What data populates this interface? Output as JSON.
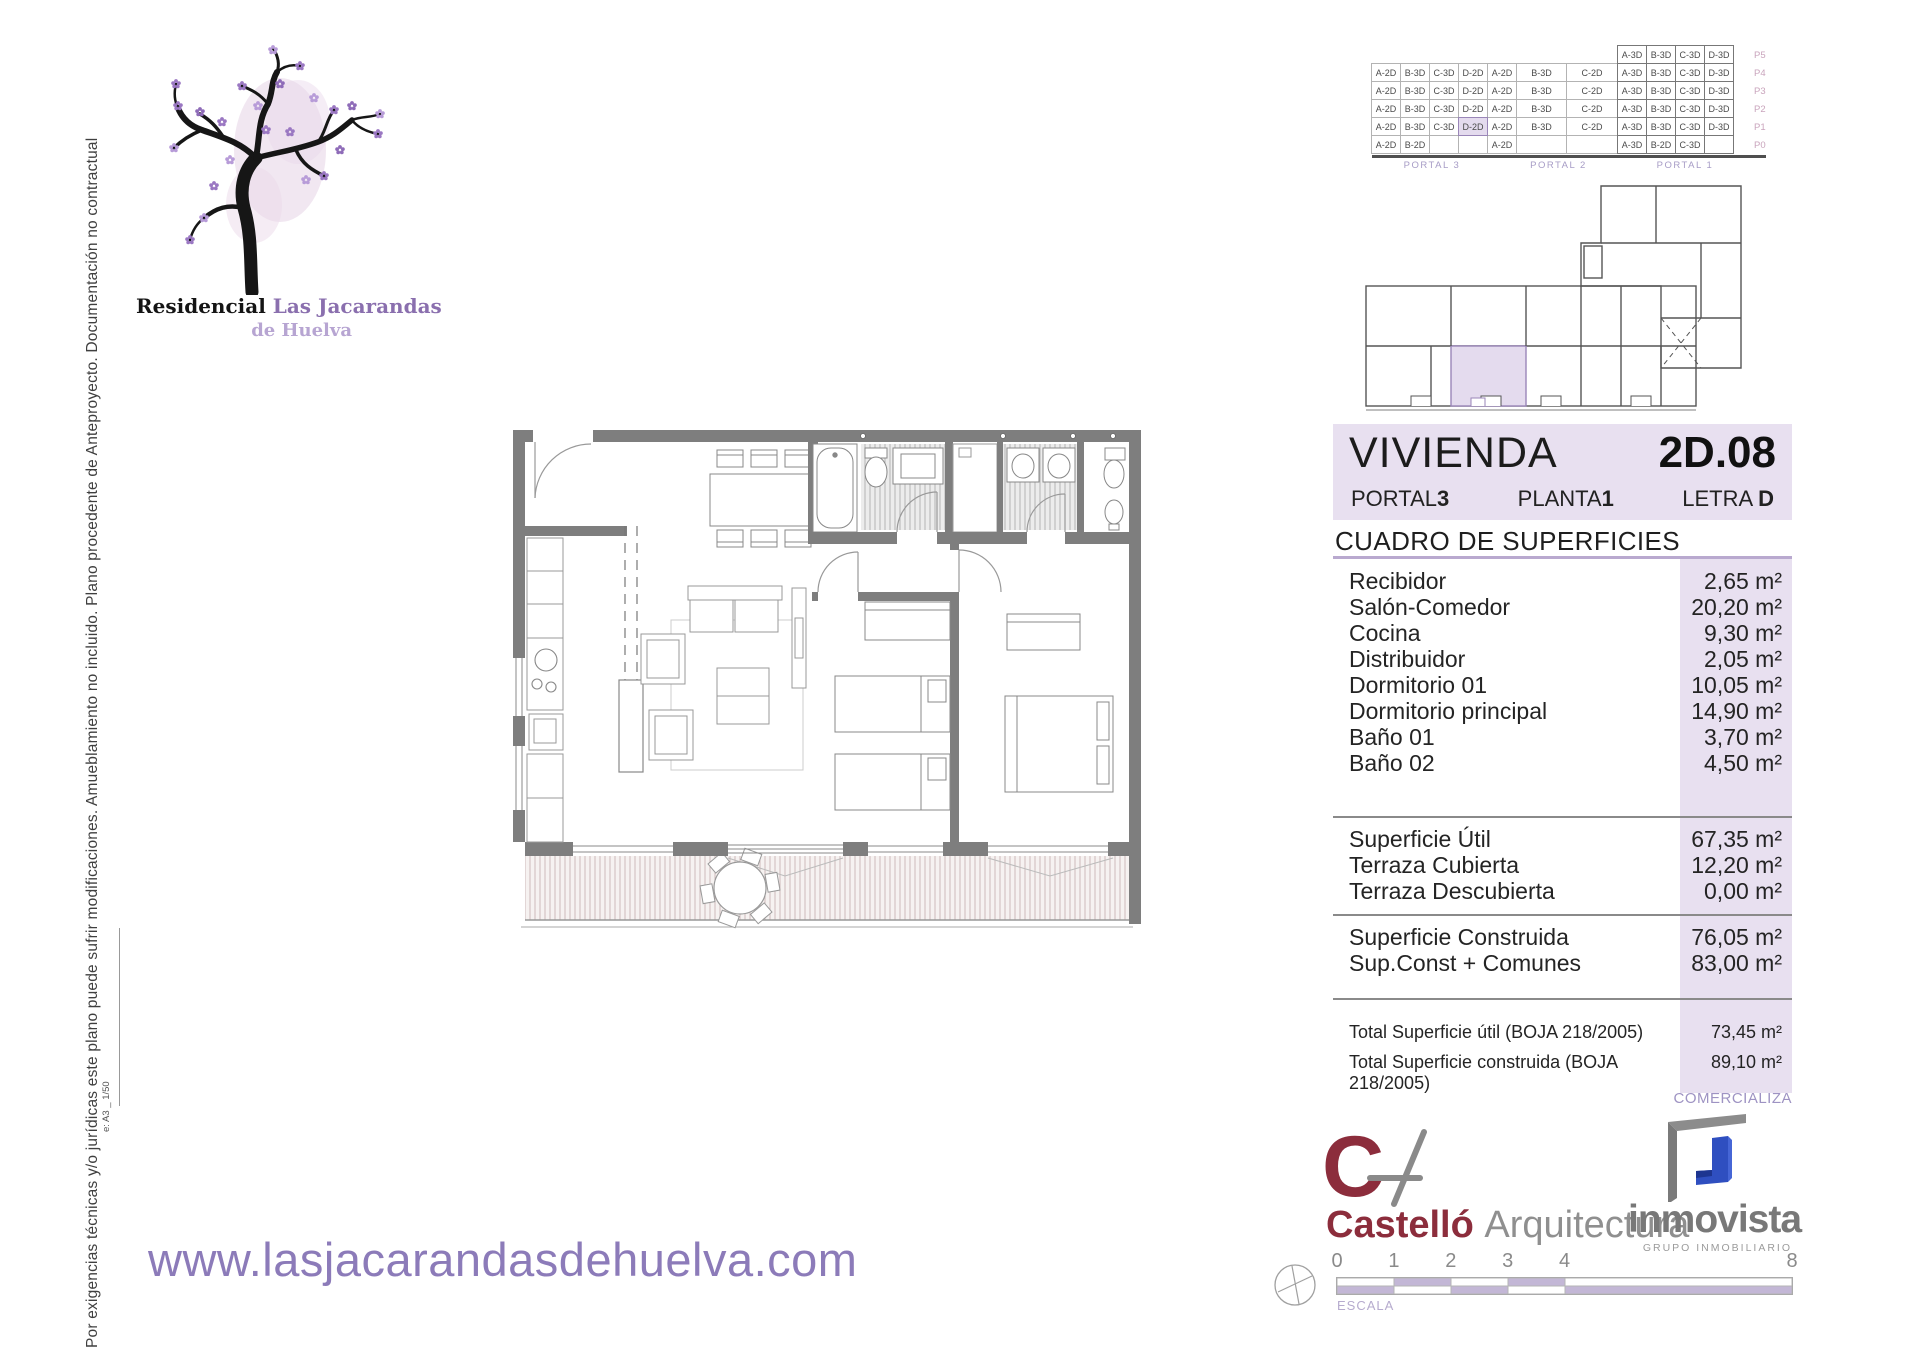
{
  "disclaimer": {
    "text": "Por exigencias técnicas y/o jurídicas este plano puede sufrir modificaciones. Amueblamiento no incluido. Plano procedente de Anteproyecto. Documentación no contractual",
    "code": "e: A3 _ 1/50"
  },
  "logo": {
    "brand_prefix": "Residencial ",
    "brand_name": "Las Jacarandas",
    "brand_suffix": "de Huelva"
  },
  "website": "www.lasjacarandasdehuelva.com",
  "unit_header": {
    "title": "VIVIENDA",
    "unit": "2D.08",
    "portal_label": "PORTAL",
    "portal": "3",
    "floor_label": "PLANTA",
    "floor": "1",
    "letter_label": "LETRA",
    "letter": "D"
  },
  "surfaces": {
    "title": "CUADRO DE SUPERFICIES",
    "rooms": [
      {
        "label": "Recibidor",
        "value": "2,65 m²"
      },
      {
        "label": "Salón-Comedor",
        "value": "20,20 m²"
      },
      {
        "label": "Cocina",
        "value": "9,30 m²"
      },
      {
        "label": "Distribuidor",
        "value": "2,05 m²"
      },
      {
        "label": "Dormitorio 01",
        "value": "10,05 m²"
      },
      {
        "label": "Dormitorio principal",
        "value": "14,90 m²"
      },
      {
        "label": "Baño 01",
        "value": "3,70 m²"
      },
      {
        "label": "Baño 02",
        "value": "4,50 m²"
      }
    ],
    "subtotals": [
      {
        "label": "Superficie Útil",
        "value": "67,35 m²"
      },
      {
        "label": "Terraza Cubierta",
        "value": "12,20 m²"
      },
      {
        "label": "Terraza Descubierta",
        "value": "0,00 m²"
      }
    ],
    "built": [
      {
        "label": "Superficie Construida",
        "value": "76,05 m²"
      },
      {
        "label": "Sup.Const + Comunes",
        "value": "83,00 m²"
      }
    ],
    "totals": [
      {
        "label": "Total Superficie útil (BOJA 218/2005)",
        "value": "73,45 m²"
      },
      {
        "label": "Total Superficie construida (BOJA 218/2005)",
        "value": "89,10 m²"
      }
    ]
  },
  "commercializes_label": "COMERCIALIZA",
  "matrix": {
    "col_widths": [
      30,
      30,
      30,
      30,
      30,
      51,
      52,
      30,
      30,
      30,
      30
    ],
    "floors": [
      "P5",
      "P4",
      "P3",
      "P2",
      "P1",
      "P0"
    ],
    "portal_groups": [
      {
        "label": "PORTAL 3",
        "start": 0,
        "span": 4
      },
      {
        "label": "PORTAL 2",
        "start": 4,
        "span": 3
      },
      {
        "label": "PORTAL 1",
        "start": 7,
        "span": 4
      }
    ],
    "rows": [
      {
        "floor": "P5",
        "cells": [
          null,
          null,
          null,
          null,
          null,
          null,
          null,
          "A-3D",
          "B-3D",
          "C-3D",
          "D-3D"
        ]
      },
      {
        "floor": "P4",
        "cells": [
          "A-2D",
          "B-3D",
          "C-3D",
          "D-2D",
          "A-2D",
          "B-3D",
          "C-2D",
          "A-3D",
          "B-3D",
          "C-3D",
          "D-3D"
        ]
      },
      {
        "floor": "P3",
        "cells": [
          "A-2D",
          "B-3D",
          "C-3D",
          "D-2D",
          "A-2D",
          "B-3D",
          "C-2D",
          "A-3D",
          "B-3D",
          "C-3D",
          "D-3D"
        ]
      },
      {
        "floor": "P2",
        "cells": [
          "A-2D",
          "B-3D",
          "C-3D",
          "D-2D",
          "A-2D",
          "B-3D",
          "C-2D",
          "A-3D",
          "B-3D",
          "C-3D",
          "D-3D"
        ]
      },
      {
        "floor": "P1",
        "cells": [
          "A-2D",
          "B-3D",
          "C-3D",
          "D-2D",
          "A-2D",
          "B-3D",
          "C-2D",
          "A-3D",
          "B-3D",
          "C-3D",
          "D-3D"
        ],
        "highlight": 3
      },
      {
        "floor": "P0",
        "cells": [
          "A-2D",
          "B-2D",
          "",
          "",
          "A-2D",
          "",
          "",
          "A-3D",
          "B-2D",
          "C-3D",
          ""
        ]
      }
    ]
  },
  "architect": {
    "name": "Castelló ",
    "suffix": "Arquitectura"
  },
  "marketer": {
    "name": "inmovista",
    "subtitle": "GRUPO INMOBILIARIO"
  },
  "scalebar": {
    "label": "ESCALA",
    "ticks": [
      "0",
      "1",
      "2",
      "3",
      "4",
      "8"
    ],
    "units": [
      0,
      1,
      2,
      3,
      4,
      8
    ],
    "total": 8
  },
  "colors": {
    "accent_lavender": "#e8e0f0",
    "accent_purple": "#b9a9cf",
    "brand_purple": "#8c7bb9",
    "maroon": "#8c2d3c",
    "wall_gray": "#7e7e7e",
    "inmovista_blue": "#2f4fc0"
  }
}
